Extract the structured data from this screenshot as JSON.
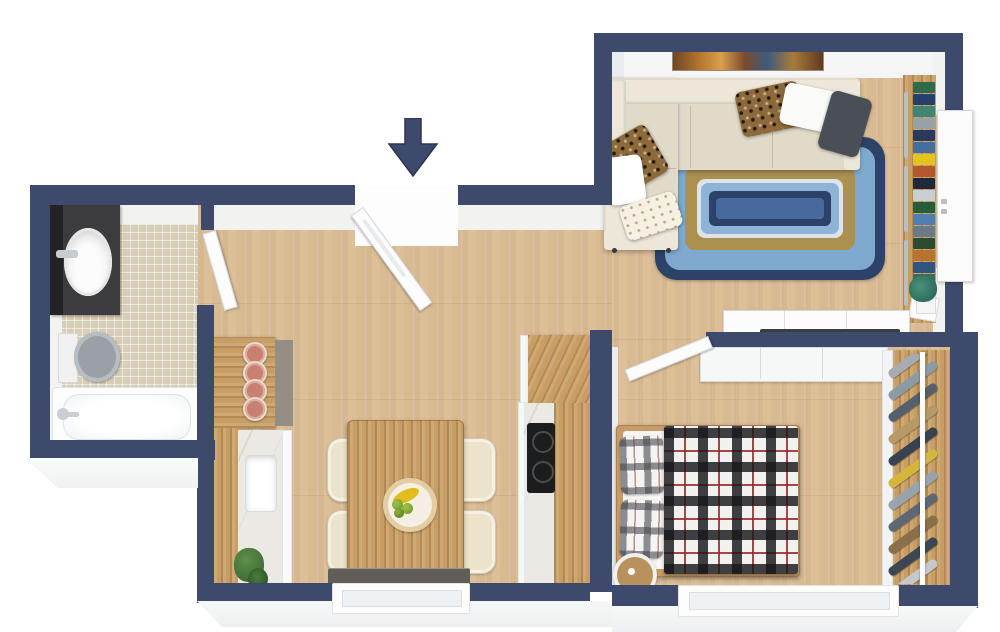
{
  "floorplan": {
    "view": "3d-top-down-apartment-floor-plan",
    "entry_indicator": "down-arrow",
    "rooms": [
      {
        "name": "Bathroom",
        "items": [
          "vanity with oval sink",
          "mirror",
          "toilet",
          "bathtub",
          "mosaic tile floor",
          "door"
        ]
      },
      {
        "name": "Hallway",
        "items": [
          "entry door",
          "entry arrow"
        ]
      },
      {
        "name": "Kitchen",
        "items": [
          "bar counter",
          "4 terracotta bar stools",
          "counter with sink",
          "tall cabinet",
          "cooktop",
          "plant"
        ]
      },
      {
        "name": "Dining Area",
        "items": [
          "wooden dining table",
          "4 cream chairs",
          "fruit bowl with bananas and apples",
          "radiator bench",
          "window"
        ]
      },
      {
        "name": "Living Room",
        "items": [
          "beige corner sofa",
          "6 throw pillows",
          "braided blue area rug",
          "wall art",
          "bookshelf",
          "white sideboard",
          "media panel",
          "plant",
          "terrace door"
        ]
      },
      {
        "name": "Bedroom",
        "items": [
          "double bed with plaid duvet",
          "2 plaid pillows",
          "round bedside table",
          "white wardrobe",
          "open clothes rack",
          "door",
          "window"
        ]
      }
    ],
    "counts": {
      "bar_stools": 4,
      "dining_chairs": 4,
      "sofa_pillows": 6,
      "bed_pillows": 2,
      "windows": 2
    }
  },
  "palette": {
    "wall": "#3e4a6c",
    "wall-dark": "#2b3552",
    "floor-wood": "#dcbf99",
    "cab-wood": "#c79e66",
    "tile": "#d8cdb6",
    "marble": "#ebe9e4",
    "face": "#f2f3f1",
    "sofa": "#e0dac9",
    "sofa-light": "#ece7d9",
    "rug-navy": "#2c4269",
    "rug-blue": "#7fa9cf",
    "rug-blue2": "#8fb3d6",
    "rug-gold": "#ab904f",
    "rug-center": "#48699c",
    "terracotta": "#c98070",
    "charcoal": "#494e57",
    "leopard": "#8d6a3c",
    "gray-fixture": "#9aa0a5",
    "dark-counter": "#948e84",
    "radiator": "#615e57",
    "plant-green": "#3f6d35",
    "plant-teal": "#2e6e5e",
    "banana": "#e2bd1e",
    "apple": "#7aa12c",
    "cooktop": "#1c1d1f",
    "vanity": "#3c3c3e",
    "mirror": "#232325"
  },
  "book_spine_colors": [
    "#2f6b4a",
    "#24406b",
    "#3f8574",
    "#97a1a6",
    "#2b3a5c",
    "#456e9e",
    "#e6c41e",
    "#b2582c",
    "#20293a",
    "#c9cfd3",
    "#265c3a",
    "#517fb0",
    "#6a7a88",
    "#2d4a33",
    "#b8742f",
    "#32547e",
    "#3d6b5c",
    "#8a9298"
  ],
  "clothes_colors": [
    "#a6acb1",
    "#8d9aa6",
    "#55606c",
    "#b59a68",
    "#39434f",
    "#d4b63c",
    "#99a3ad",
    "#5d6874",
    "#8b6f4a",
    "#3d4754",
    "#c3c9cd"
  ]
}
